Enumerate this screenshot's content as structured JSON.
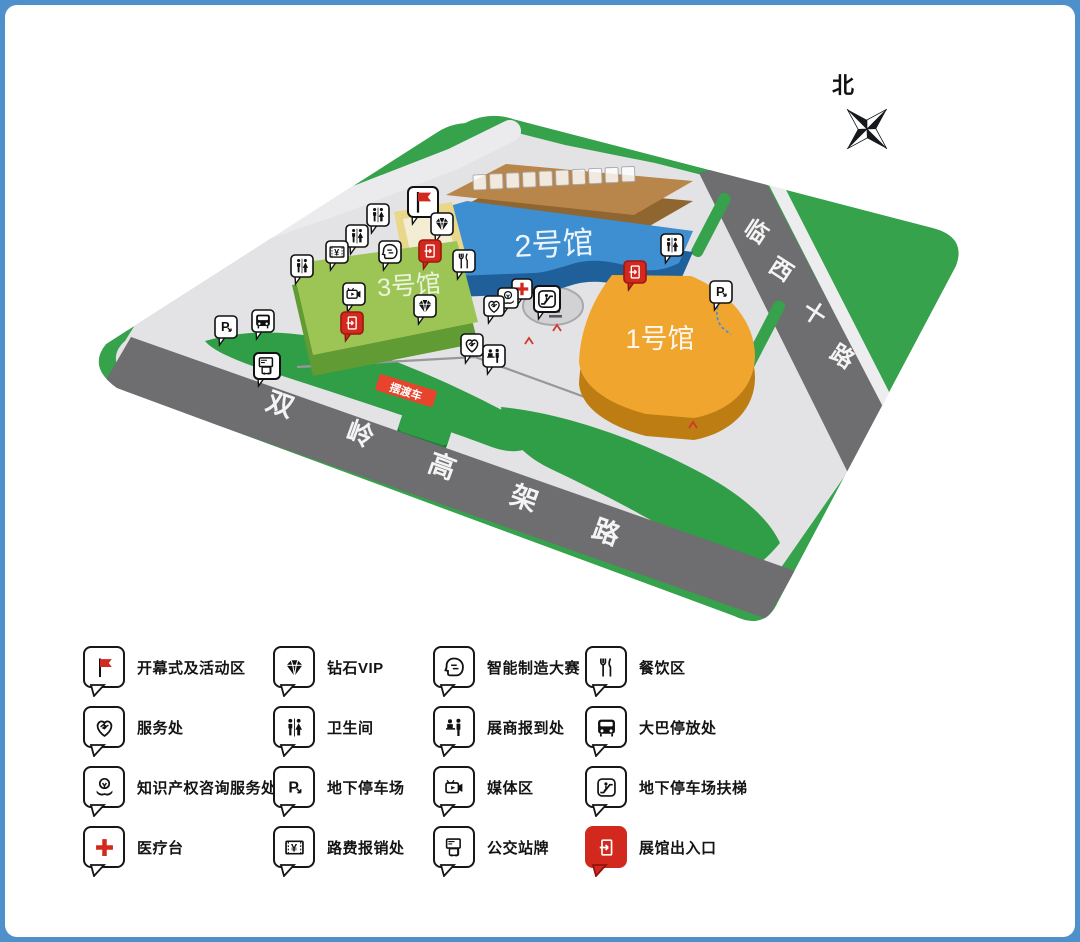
{
  "frame": {
    "border_color": "#4e90c9",
    "background": "#ffffff"
  },
  "compass": {
    "label": "北"
  },
  "map": {
    "halls": [
      {
        "id": "hall1",
        "label": "1号馆",
        "top_color": "#f0a52e",
        "side_color": "#bd7d13"
      },
      {
        "id": "hall2",
        "label": "2号馆",
        "top_color": "#3e8ed2",
        "side_color": "#20609a"
      },
      {
        "id": "hall3",
        "label": "3号馆",
        "top_color": "#9dc556",
        "side_color": "#619b33"
      },
      {
        "id": "hotel",
        "label": "",
        "top_color": "#b8854a",
        "side_color": "#8f6630"
      }
    ],
    "roads": [
      {
        "id": "shuangling",
        "label": "双岭高架路",
        "color": "#6e6e70"
      },
      {
        "id": "linxi",
        "label": "临西十路",
        "color": "#6e6e70"
      }
    ],
    "banner": {
      "label": "摆渡车",
      "color": "#e8432c"
    },
    "zone_colors": {
      "land": "#36a24c",
      "plaza": "#e3e3e6",
      "lawn": "#2f9e47",
      "opening_outer": "#e9d78b",
      "opening_inner": "#f3eed3"
    },
    "markers": [
      {
        "icon": "flag",
        "x": 418,
        "y": 197,
        "size": 30
      },
      {
        "icon": "restroom",
        "x": 373,
        "y": 210
      },
      {
        "icon": "diamond",
        "x": 437,
        "y": 219
      },
      {
        "icon": "restroom",
        "x": 352,
        "y": 231
      },
      {
        "icon": "restroom",
        "x": 667,
        "y": 240
      },
      {
        "icon": "exit",
        "x": 425,
        "y": 246
      },
      {
        "icon": "aihead",
        "x": 385,
        "y": 247
      },
      {
        "icon": "toll",
        "x": 332,
        "y": 247
      },
      {
        "icon": "dining",
        "x": 459,
        "y": 256
      },
      {
        "icon": "restroom",
        "x": 297,
        "y": 261
      },
      {
        "icon": "exit",
        "x": 630,
        "y": 267
      },
      {
        "icon": "medical",
        "x": 517,
        "y": 284,
        "size": 20
      },
      {
        "icon": "parking",
        "x": 716,
        "y": 287
      },
      {
        "icon": "media",
        "x": 349,
        "y": 289
      },
      {
        "icon": "knowledge",
        "x": 503,
        "y": 293,
        "size": 20
      },
      {
        "icon": "escalator",
        "x": 542,
        "y": 294,
        "size": 26
      },
      {
        "icon": "service",
        "x": 489,
        "y": 301,
        "size": 20
      },
      {
        "icon": "diamond",
        "x": 420,
        "y": 301
      },
      {
        "icon": "bus",
        "x": 258,
        "y": 316
      },
      {
        "icon": "exit",
        "x": 347,
        "y": 318
      },
      {
        "icon": "parking",
        "x": 221,
        "y": 322
      },
      {
        "icon": "service",
        "x": 467,
        "y": 340
      },
      {
        "icon": "regdesk",
        "x": 489,
        "y": 351
      },
      {
        "icon": "busstop",
        "x": 262,
        "y": 361,
        "size": 26
      }
    ]
  },
  "legend": {
    "rows": [
      [
        {
          "icon": "flag",
          "label": "开幕式及活动区"
        },
        {
          "icon": "diamond",
          "label": "钻石VIP"
        },
        {
          "icon": "aihead",
          "label": "智能制造大赛"
        },
        {
          "icon": "dining",
          "label": "餐饮区"
        }
      ],
      [
        {
          "icon": "service",
          "label": "服务处"
        },
        {
          "icon": "restroom",
          "label": "卫生间"
        },
        {
          "icon": "regdesk",
          "label": "展商报到处"
        },
        {
          "icon": "bus",
          "label": "大巴停放处"
        }
      ],
      [
        {
          "icon": "knowledge",
          "label": "知识产权咨询服务处"
        },
        {
          "icon": "parking",
          "label": "地下停车场"
        },
        {
          "icon": "media",
          "label": "媒体区"
        },
        {
          "icon": "escalator",
          "label": "地下停车场扶梯"
        }
      ],
      [
        {
          "icon": "medical",
          "label": "医疗台"
        },
        {
          "icon": "toll",
          "label": "路费报销处"
        },
        {
          "icon": "busstop",
          "label": "公交站牌"
        },
        {
          "icon": "exit",
          "label": "展馆出入口"
        }
      ]
    ]
  }
}
